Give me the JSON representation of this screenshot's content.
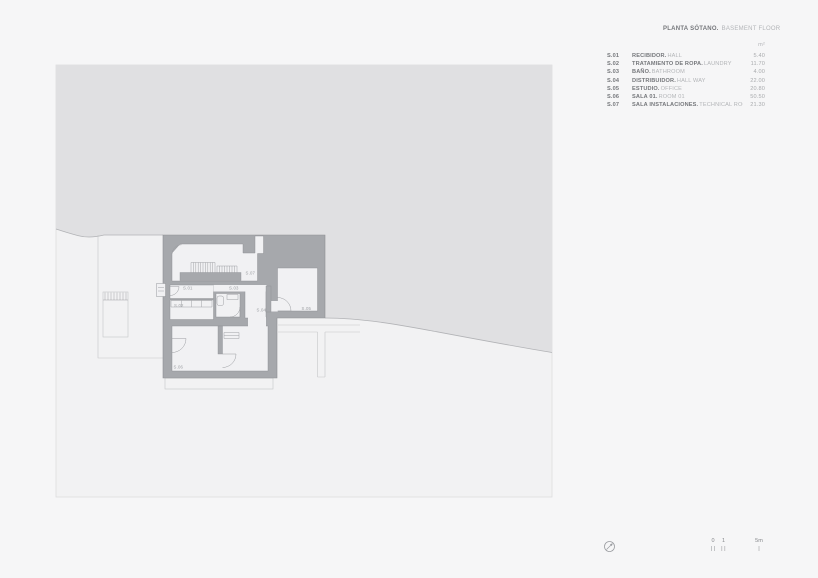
{
  "header": {
    "title_primary": "PLANTA SÓTANO.",
    "title_secondary": "BASEMENT FLOOR"
  },
  "legend": {
    "unit": "m²",
    "rows": [
      {
        "code": "S.01",
        "name_es": "RECIBIDOR.",
        "name_en": "HALL",
        "area": "5.40"
      },
      {
        "code": "S.02",
        "name_es": "TRATAMIENTO DE ROPA.",
        "name_en": "LAUNDRY",
        "area": "11.70"
      },
      {
        "code": "S.03",
        "name_es": "BAÑO.",
        "name_en": "BATHROOM",
        "area": "4.00"
      },
      {
        "code": "S.04",
        "name_es": "DISTRIBUIDOR.",
        "name_en": "HALL WAY",
        "area": "22.00"
      },
      {
        "code": "S.05",
        "name_es": "ESTUDIO.",
        "name_en": "OFFICE",
        "area": "20.80"
      },
      {
        "code": "S.06",
        "name_es": "SALA 01.",
        "name_en": "ROOM 01",
        "area": "50.50"
      },
      {
        "code": "S.07",
        "name_es": "SALA INSTALACIONES.",
        "name_en": "TECHNICAL ROOM",
        "area": "21.30"
      }
    ]
  },
  "plan": {
    "labels": {
      "s01": "S.01",
      "s02": "S.02",
      "s03": "S.03",
      "s04": "S.04",
      "s05": "S.05",
      "s06": "S.06",
      "s07": "S.07"
    }
  },
  "scalebar": {
    "zero": "0",
    "one": "1",
    "five": "5m"
  },
  "colors": {
    "page_background": "#f6f6f7",
    "terrain_fill": "#e0e0e2",
    "terrain_edge": "#b2b3b6",
    "wall_fill": "#a6a8ac",
    "room_fill": "#f1f1f3",
    "text_dark": "#75777b",
    "text_light": "#b3b5b8"
  }
}
